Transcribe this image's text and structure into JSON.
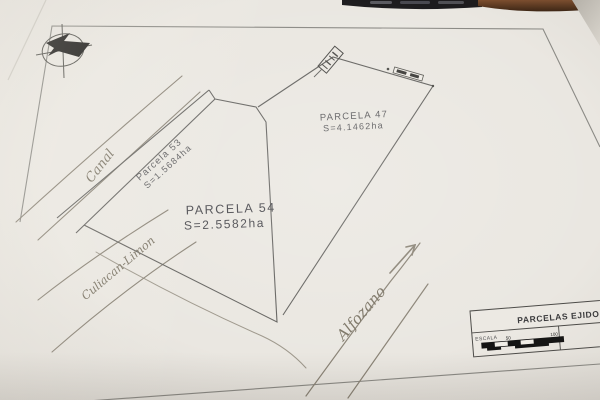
{
  "photo": {
    "description": "photographed paper plan",
    "paper_color": "#eae7e1",
    "pencil_color": "#8a8376",
    "print_line_color": "#63625f",
    "top_strip_color": "#1d1c1e",
    "edge_brown_color": "#6e452a"
  },
  "compass": {
    "icon": "north-arrow"
  },
  "parcels": [
    {
      "label": "PARCELA 47",
      "area": "S=4.1462ha"
    },
    {
      "label": "Parcela 53",
      "area": "S=1.5684ha"
    },
    {
      "label": "PARCELA 54",
      "area": "S=2.5582ha"
    }
  ],
  "annotations": {
    "canal": "Canal",
    "road": "Culiacan-Limon",
    "direction": "Alfozano"
  },
  "title_block": {
    "title": "PARCELAS EJIDO L",
    "scale_label": "ESCALA",
    "scale_ticks": [
      "50",
      "100"
    ]
  }
}
